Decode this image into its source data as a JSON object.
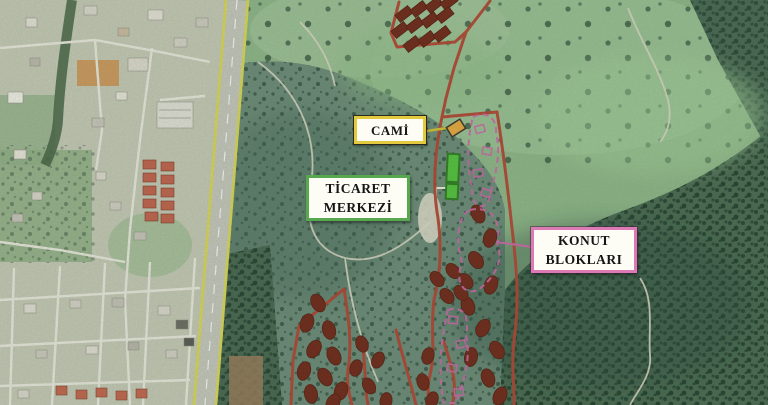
{
  "map": {
    "type": "satellite-annotation-map",
    "labels": {
      "cami": "CAMİ",
      "ticaret_line1": "TİCARET",
      "ticaret_line2": "MERKEZİ",
      "konut_line1": "KONUT",
      "konut_line2": "BLOKLARI"
    },
    "colors": {
      "site_boundary_red": "#b4402e",
      "building_block_red": "#6f2415",
      "housing_zone_pink": "#cf64a8",
      "commerce_site_green": "#52c23a",
      "mosque_site_orange": "#e8a83c",
      "cami_leader_yellow": "#d8c12c",
      "highway_stripe_yellow": "#ddd84e",
      "cami_label_border": "#e3c93e",
      "ticaret_label_border": "#57a84e",
      "konut_label_border": "#db7ab4"
    }
  }
}
